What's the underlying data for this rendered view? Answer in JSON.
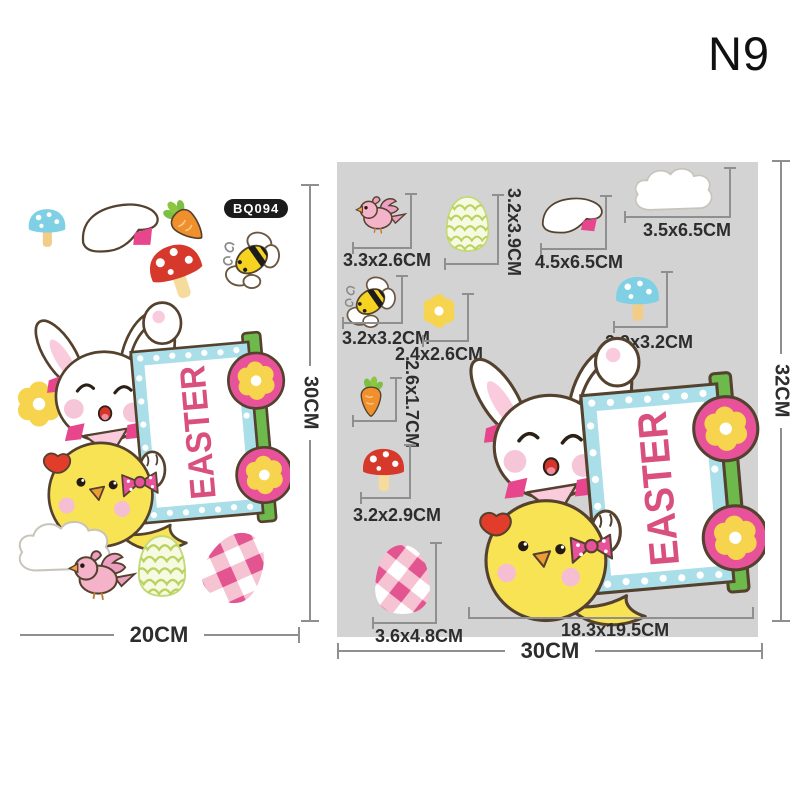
{
  "header": {
    "code": "N9"
  },
  "sign": {
    "text": "EASTER"
  },
  "left_sheet": {
    "sku": "BQ094",
    "width_label": "20CM",
    "height_label": "30CM",
    "icons": [
      "mushroom-blue",
      "bunny-ear",
      "carrot",
      "bee",
      "mushroom-red",
      "flower",
      "bunny-chick-easter-sign",
      "cloud",
      "bird",
      "egg-green",
      "egg-plaid"
    ]
  },
  "panel": {
    "width_label": "30CM",
    "height_label": "32CM",
    "items": [
      {
        "icon": "bird",
        "size": "3.3x2.6CM"
      },
      {
        "icon": "egg-green",
        "size": "3.2x3.9CM"
      },
      {
        "icon": "bunny-ear",
        "size": "4.5x6.5CM"
      },
      {
        "icon": "cloud",
        "size": "3.5x6.5CM"
      },
      {
        "icon": "bee",
        "size": "3.2x3.2CM"
      },
      {
        "icon": "flower",
        "size": "2.4x2.6CM"
      },
      {
        "icon": "mushroom-blue",
        "size": "2.9x3.2CM"
      },
      {
        "icon": "carrot",
        "size": "2.6x1.7CM"
      },
      {
        "icon": "mushroom-red",
        "size": "3.2x2.9CM"
      },
      {
        "icon": "egg-plaid",
        "size": "3.6x4.8CM"
      },
      {
        "icon": "bunny-chick-easter-sign",
        "size": "18.3x19.5CM"
      }
    ]
  },
  "colors": {
    "panel_bg": "#d3d3d3",
    "measure_line": "#8f8f8f",
    "easter_text": "#d9507e",
    "sign_blue": "#aadee9",
    "post_green": "#6eb94b",
    "medallion_pink": "#e8529a",
    "flower_yellow": "#f6d44e",
    "chick_yellow": "#f8e354",
    "badge_bg": "#1b1b1b"
  }
}
